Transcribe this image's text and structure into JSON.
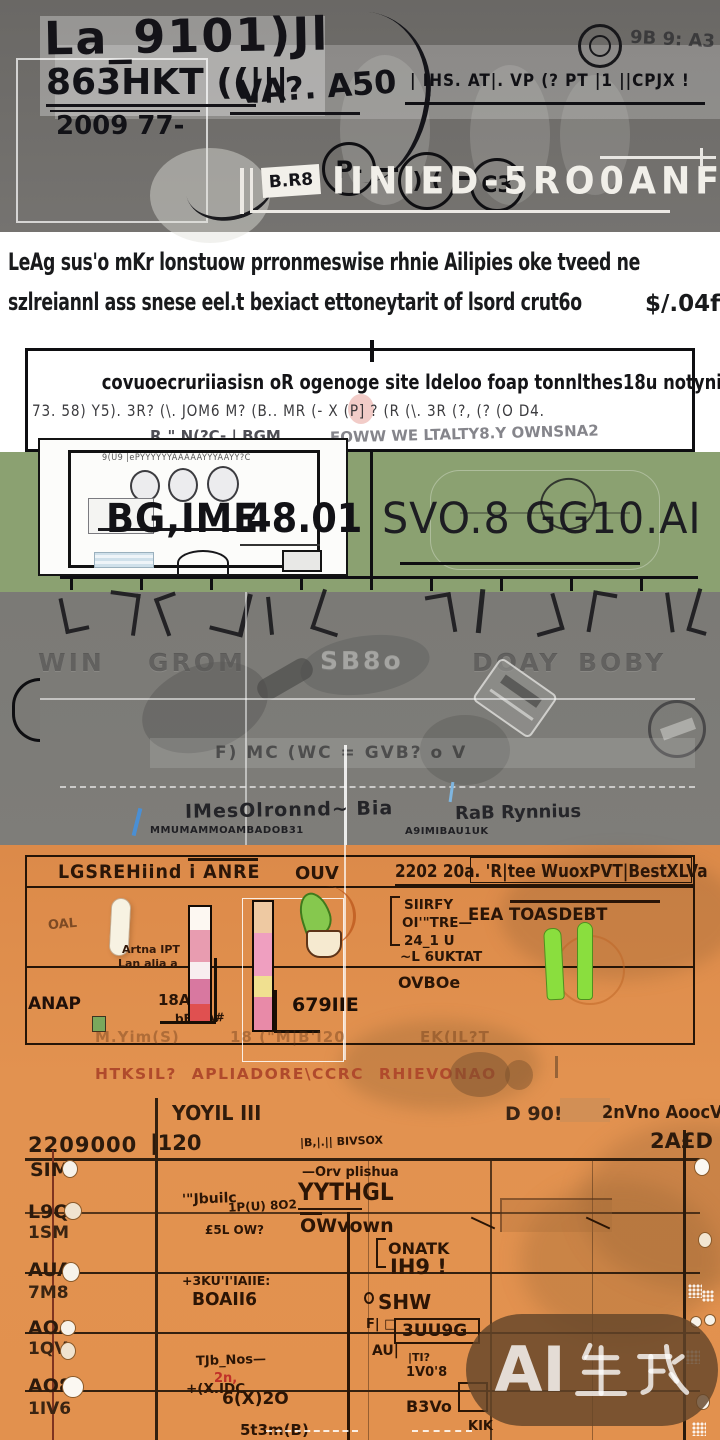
{
  "header": {
    "logo_line1": "La_9101)Jl",
    "logo_line2": "863HKT ((|||",
    "logo_line3": "2009 77-",
    "mid_mark": "VA?. A50",
    "permit_line": "| IHS. AT|. VP (? PT |1 ||CPJX !",
    "stamp1": "P-",
    "stamp2": ")-(",
    "stamp3": "C3",
    "corner_marks": "9B  9:  A3",
    "banner_tag": "B.R8",
    "banner_title": "IINIED-5RO0ANF"
  },
  "intro": {
    "line1": "LeAg sus'o mKr lonstuow prronmeswise rhnie Ailipies oke tveed ne",
    "line2": "szlreiannl ass snese eel.t bexiact ettoneytarit of lsord crut6o",
    "amount": "$/.04f"
  },
  "notice": {
    "title": "covuoecruriiasisn oR ogenoge site ldeloo foap tonnlthes18u notynictan",
    "glyphs": "73. 58)  Y5). 3R?  (\\. JOM6   M? (B.. MR (- X  (P] ? (R   (\\. 3R (?, (? (O   D4.",
    "subline_left": "R.\" N(?C- | BGM",
    "subline_right": "EOWW WE LTALTY8.Y OWNSNA2"
  },
  "plan_card": {
    "scribble_top": "9(U9  |ePYYYYYYAAAAAYYYAAYY?C",
    "label": "BG,IME",
    "value": "48.01"
  },
  "green_panel": {
    "headline": "SVO.8 GG10.AI"
  },
  "gray_band": {
    "embossed": [
      "WIN",
      "GROM",
      "SB8o",
      "DOAY",
      "BOBY"
    ],
    "strip_glyphs": "F)  MC (WC  =  GVB? o V",
    "caption_left": "IMesOlronnd~ Bia",
    "caption_small_1": "MMUMAMMOAMBADOB31",
    "caption_small_2": "A9IMIBAU1UK",
    "caption_right": "RaB  Rynnius"
  },
  "spec_table": {
    "col1_header": "LGSREHiind i ANRE",
    "col2_header": "OUV",
    "col3_header": "2202 20a. 'R|tee WuoxPVT|BestXLVa",
    "left_mark": "OAL",
    "bar_caption_1": "Artna IPT",
    "bar_caption_2": "Lan alia a",
    "bar_caption_3": "18AIL",
    "bar_caption_4": "bERIA#",
    "mid_value": "679IIE",
    "left_footer": "ANAP",
    "right_list_1": "SIIRFY",
    "right_list_2": "OI'\"TRE—",
    "right_list_3": "24_1 U",
    "right_list_4": "~L 6UKTAT",
    "right_title": "EEA  TOASDEBT",
    "right_value": "OVBOe",
    "footer_1": "M.Yim(S)",
    "footer_2": "18 (\"M|B'I20",
    "footer_3": "EK(IL?T"
  },
  "schedule": {
    "caption": "HTKSIL?  APLIADORE\\CCRC  RHIEVONAO",
    "header_mid": "YOYIL  III",
    "header_right1": "D 90!",
    "header_right2": "2nVno AoocVb",
    "axis_left": "2209000",
    "axis_mid": "|120",
    "axis_right": "2A£D",
    "rows": [
      {
        "label": "SIM",
        "sub": ""
      },
      {
        "label": "L9Q",
        "sub": "1SM"
      },
      {
        "label": "AUA",
        "sub": "7M8"
      },
      {
        "label": "AOA",
        "sub": "1QV"
      },
      {
        "label": "AO8",
        "sub": "1IV6"
      }
    ],
    "tasks": {
      "t1": "|B,|.|| BIVSOX",
      "t2": "—Orv plishua",
      "t3": "YYTHGL",
      "t4": "1P(U) 8O2",
      "t5": "'\"Jbuilc",
      "t6": "£5L OW?",
      "t7": "OWvown",
      "t8": "ONATK",
      "t9": "IH9 !",
      "t10": "+3KU'I'IAIIE:",
      "t11": "BOAII6",
      "t12": "SHW",
      "t13": "F| □",
      "t14": "3UU9G",
      "t15": "AU|",
      "t16": "|TI?",
      "t17": "1V0'8",
      "t18": "TJb_Nos—",
      "t19": "+(X.IDC",
      "t20": "6(X)2O",
      "t21": "2n,",
      "t22": "B3Vo",
      "t23": "5t3m(B)",
      "t24": "KIK"
    }
  },
  "watermark": {
    "text": "AI生成",
    "latin": "AI"
  },
  "colors": {
    "header_gray": "#6f6d6a",
    "green_band": "#8ba171",
    "gray_band": "#7b7a76",
    "orange": "#df8e4c",
    "ink": "#0f0f12",
    "red_caption": "#b04a2c",
    "pink_bar": "#e89cb0",
    "green_bar": "#8ade3e",
    "watermark_bg": "#6a4a2e"
  }
}
